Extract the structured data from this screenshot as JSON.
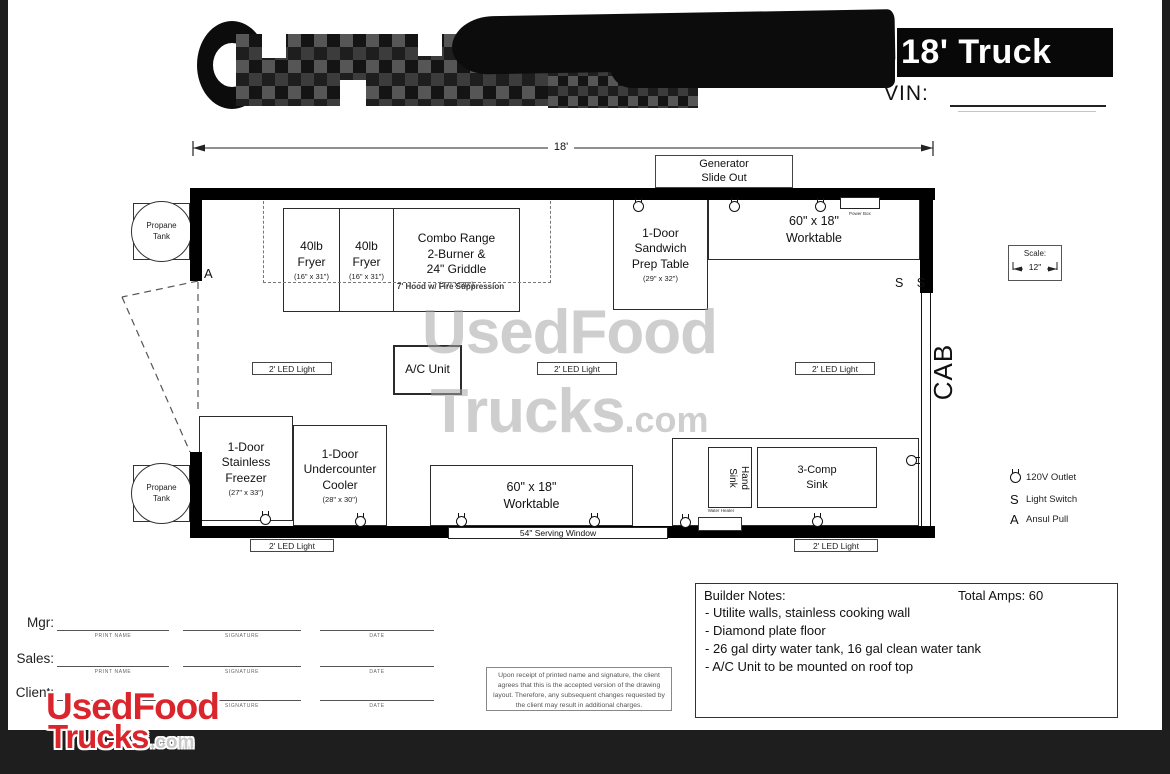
{
  "header": {
    "title": "18' Truck",
    "vin_label": "VIN:"
  },
  "plan": {
    "dimension": "18'",
    "generator": "Generator\nSlide Out",
    "hood": "7' Hood w/ Fire Suppression",
    "cab": "CAB",
    "door_label": "A",
    "switches": "S S",
    "scale_label": "Scale:",
    "scale_value": "12\"",
    "power_box": "Power Box",
    "serving_window": "54\" Serving Window",
    "led_label": "2' LED Light",
    "water_heater": "Water Heater",
    "propane": "Propane\nTank",
    "equipment": {
      "fryer": {
        "name": "40lb\nFryer",
        "dims": "(16\" x 31\")"
      },
      "combo_range": {
        "name": "Combo Range\n2-Burner &\n24\" Griddle",
        "dims": "(27\" x 30\")"
      },
      "prep_table": {
        "name": "1-Door\nSandwich\nPrep Table",
        "dims": "(29\" x 32\")"
      },
      "worktable": {
        "name": "60\" x 18\"\nWorktable"
      },
      "freezer": {
        "name": "1-Door\nStainless\nFreezer",
        "dims": "(27\" x 33\")"
      },
      "cooler": {
        "name": "1-Door\nUndercounter\nCooler",
        "dims": "(28\" x 30\")"
      },
      "hand_sink": {
        "name": "Hand\nSink"
      },
      "comp_sink": {
        "name": "3-Comp\nSink"
      },
      "ac_unit": {
        "name": "A/C Unit"
      }
    }
  },
  "legend": {
    "outlet": "120V Outlet",
    "switch_symbol": "S",
    "switch": "Light Switch",
    "ansul_symbol": "A",
    "ansul": "Ansul Pull"
  },
  "notes": {
    "title": "Builder Notes:",
    "amps": "Total Amps: 60",
    "items": [
      "- Utilite walls, stainless cooking wall",
      "- Diamond plate floor",
      "- 26 gal dirty water tank, 16 gal clean water tank",
      "- A/C Unit to be mounted on roof top"
    ]
  },
  "signatures": {
    "rows": [
      {
        "label": "Mgr:"
      },
      {
        "label": "Sales:"
      },
      {
        "label": "Client:"
      }
    ],
    "col_labels": [
      "PRINT NAME",
      "SIGNATURE",
      "DATE"
    ]
  },
  "disclaimer": "Upon receipt of printed name and signature, the client agrees that this is the accepted version of the drawing layout. Therefore, any subsequent changes requested by the client may result in additional charges.",
  "watermark": {
    "line1": "UsedFood",
    "line2": "Trucks",
    "suffix": ".com"
  },
  "brand": {
    "line1": "UsedFood",
    "line2": "Trucks",
    "suffix": ".com",
    "color": "#d9252b"
  }
}
